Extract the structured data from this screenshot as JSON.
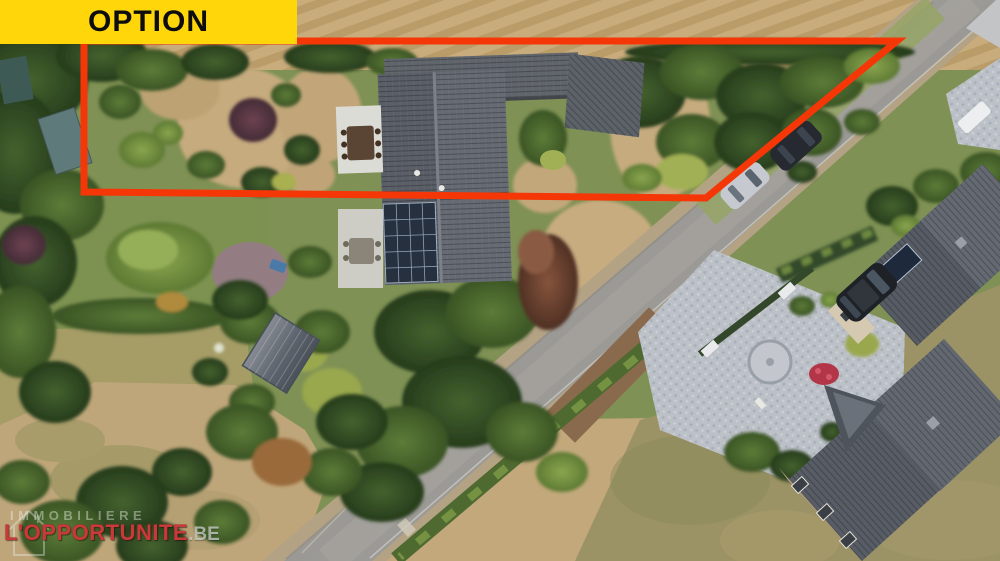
{
  "banner": {
    "label": "OPTION",
    "bg_color": "#FFD60A",
    "text_color": "#0d0d0d"
  },
  "boundary": {
    "color": "#F53708",
    "stroke_width": 7,
    "vertices": [
      [
        84,
        41
      ],
      [
        897,
        41
      ],
      [
        706,
        198
      ],
      [
        84,
        192
      ]
    ]
  },
  "watermark": {
    "line1": "IMMOBILIERE",
    "brand": "L'OPPORTUNITE",
    "tld": ".BE",
    "brand_color": "#c8393a",
    "icon": "house-outline-icon"
  },
  "scene": {
    "type": "aerial-drone-photo",
    "subject": "countryside property with red plot outline, road and neighbouring house",
    "features": [
      "plowed-field",
      "main-house-roof",
      "solar-panel-array",
      "barn-roof",
      "garden-shed",
      "white-terrace",
      "patio-terrace",
      "dining-table",
      "road",
      "grass-verge",
      "parked-cars",
      "neighbour-house",
      "cobblestone-driveway",
      "black-suv",
      "hedges",
      "trees",
      "lawn",
      "dry-field"
    ]
  }
}
